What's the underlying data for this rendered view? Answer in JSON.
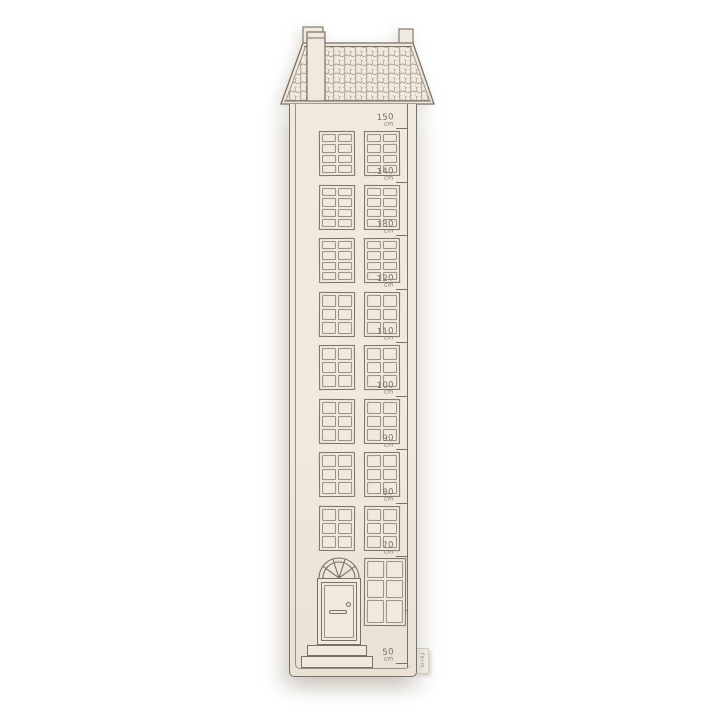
{
  "colors": {
    "background": "#ffffff",
    "fabric": "#f0e9de",
    "fabric_deep": "#e9e1d4",
    "line": "#7a7164",
    "line_light": "#998f80",
    "tag_bg": "#f7f4ee",
    "tag_text": "#8d8577"
  },
  "ruler": {
    "unit": "cm",
    "marks": [
      {
        "value": "150",
        "unit": "cm"
      },
      {
        "value": "140",
        "unit": "cm"
      },
      {
        "value": "130",
        "unit": "cm"
      },
      {
        "value": "120",
        "unit": "cm"
      },
      {
        "value": "110",
        "unit": "cm"
      },
      {
        "value": "100",
        "unit": "cm"
      },
      {
        "value": "90",
        "unit": "cm"
      },
      {
        "value": "80",
        "unit": "cm"
      },
      {
        "value": "70",
        "unit": "cm"
      },
      {
        "value": "60",
        "unit": "cm"
      },
      {
        "value": "50",
        "unit": "cm"
      }
    ]
  },
  "house": {
    "roof": {
      "pattern": "scallop-tiles",
      "left_feature": "chimney",
      "right_feature": "ridge-stack"
    },
    "window_rows": [
      {
        "panes": "2x4"
      },
      {
        "panes": "2x4"
      },
      {
        "panes": "2x4"
      },
      {
        "panes": "2x3"
      },
      {
        "panes": "2x3"
      },
      {
        "panes": "2x3"
      },
      {
        "panes": "2x3"
      },
      {
        "panes": "2x3"
      }
    ],
    "ground_floor": {
      "door": {
        "features": [
          "arched-fanlight",
          "doorknob",
          "letter-slot",
          "two-steps"
        ]
      },
      "window_panes": "2x3"
    }
  },
  "tag": {
    "text": "ferm"
  }
}
